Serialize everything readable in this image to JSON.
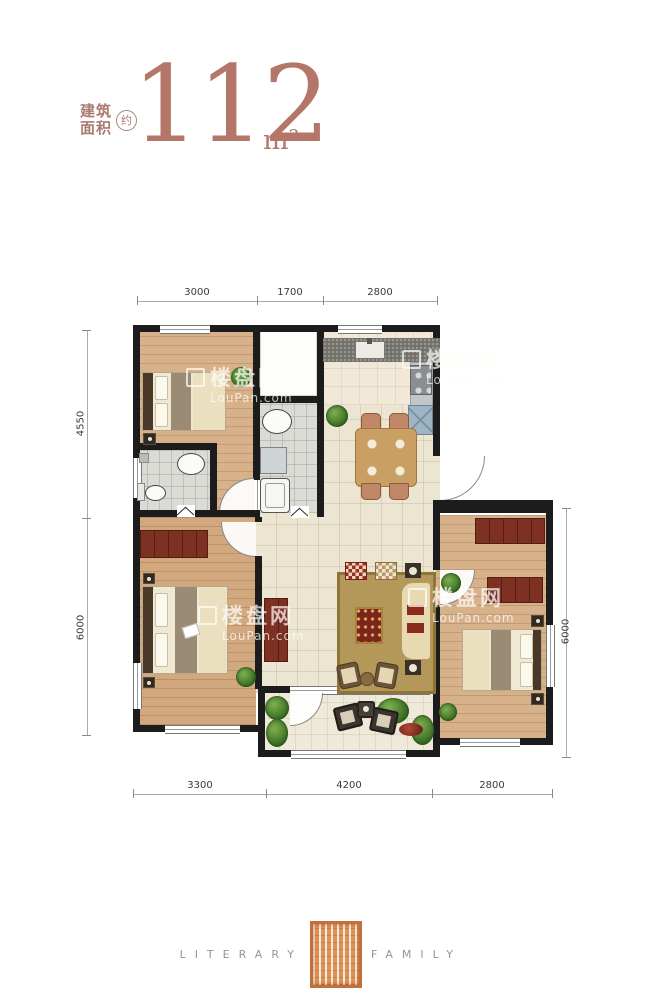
{
  "header": {
    "area_label_line1": "建筑",
    "area_label_line2": "面积",
    "approx": "约",
    "area_value": "112",
    "area_unit": "m²"
  },
  "dimensions": {
    "top": [
      "3000",
      "1700",
      "2800"
    ],
    "bottom": [
      "3300",
      "4200",
      "2800"
    ],
    "left": [
      "4550",
      "6000"
    ],
    "right": [
      "6000"
    ]
  },
  "watermark": {
    "name": "楼盘网",
    "domain": "LouPan.com"
  },
  "footer": {
    "word_left": "LITERARY",
    "word_right": "FAMILY"
  },
  "colors": {
    "accent_text": "#b5766a",
    "wall": "#1c1c1c",
    "wood_floor": "#d7b18a",
    "tile_floor": "#ece5d1",
    "bath_floor": "#dadbd5",
    "kitchen_counter": "#6f6f68",
    "furniture_red": "#7e3022",
    "seal_bronze": "#dd9256",
    "plant_green": "#35681f"
  }
}
